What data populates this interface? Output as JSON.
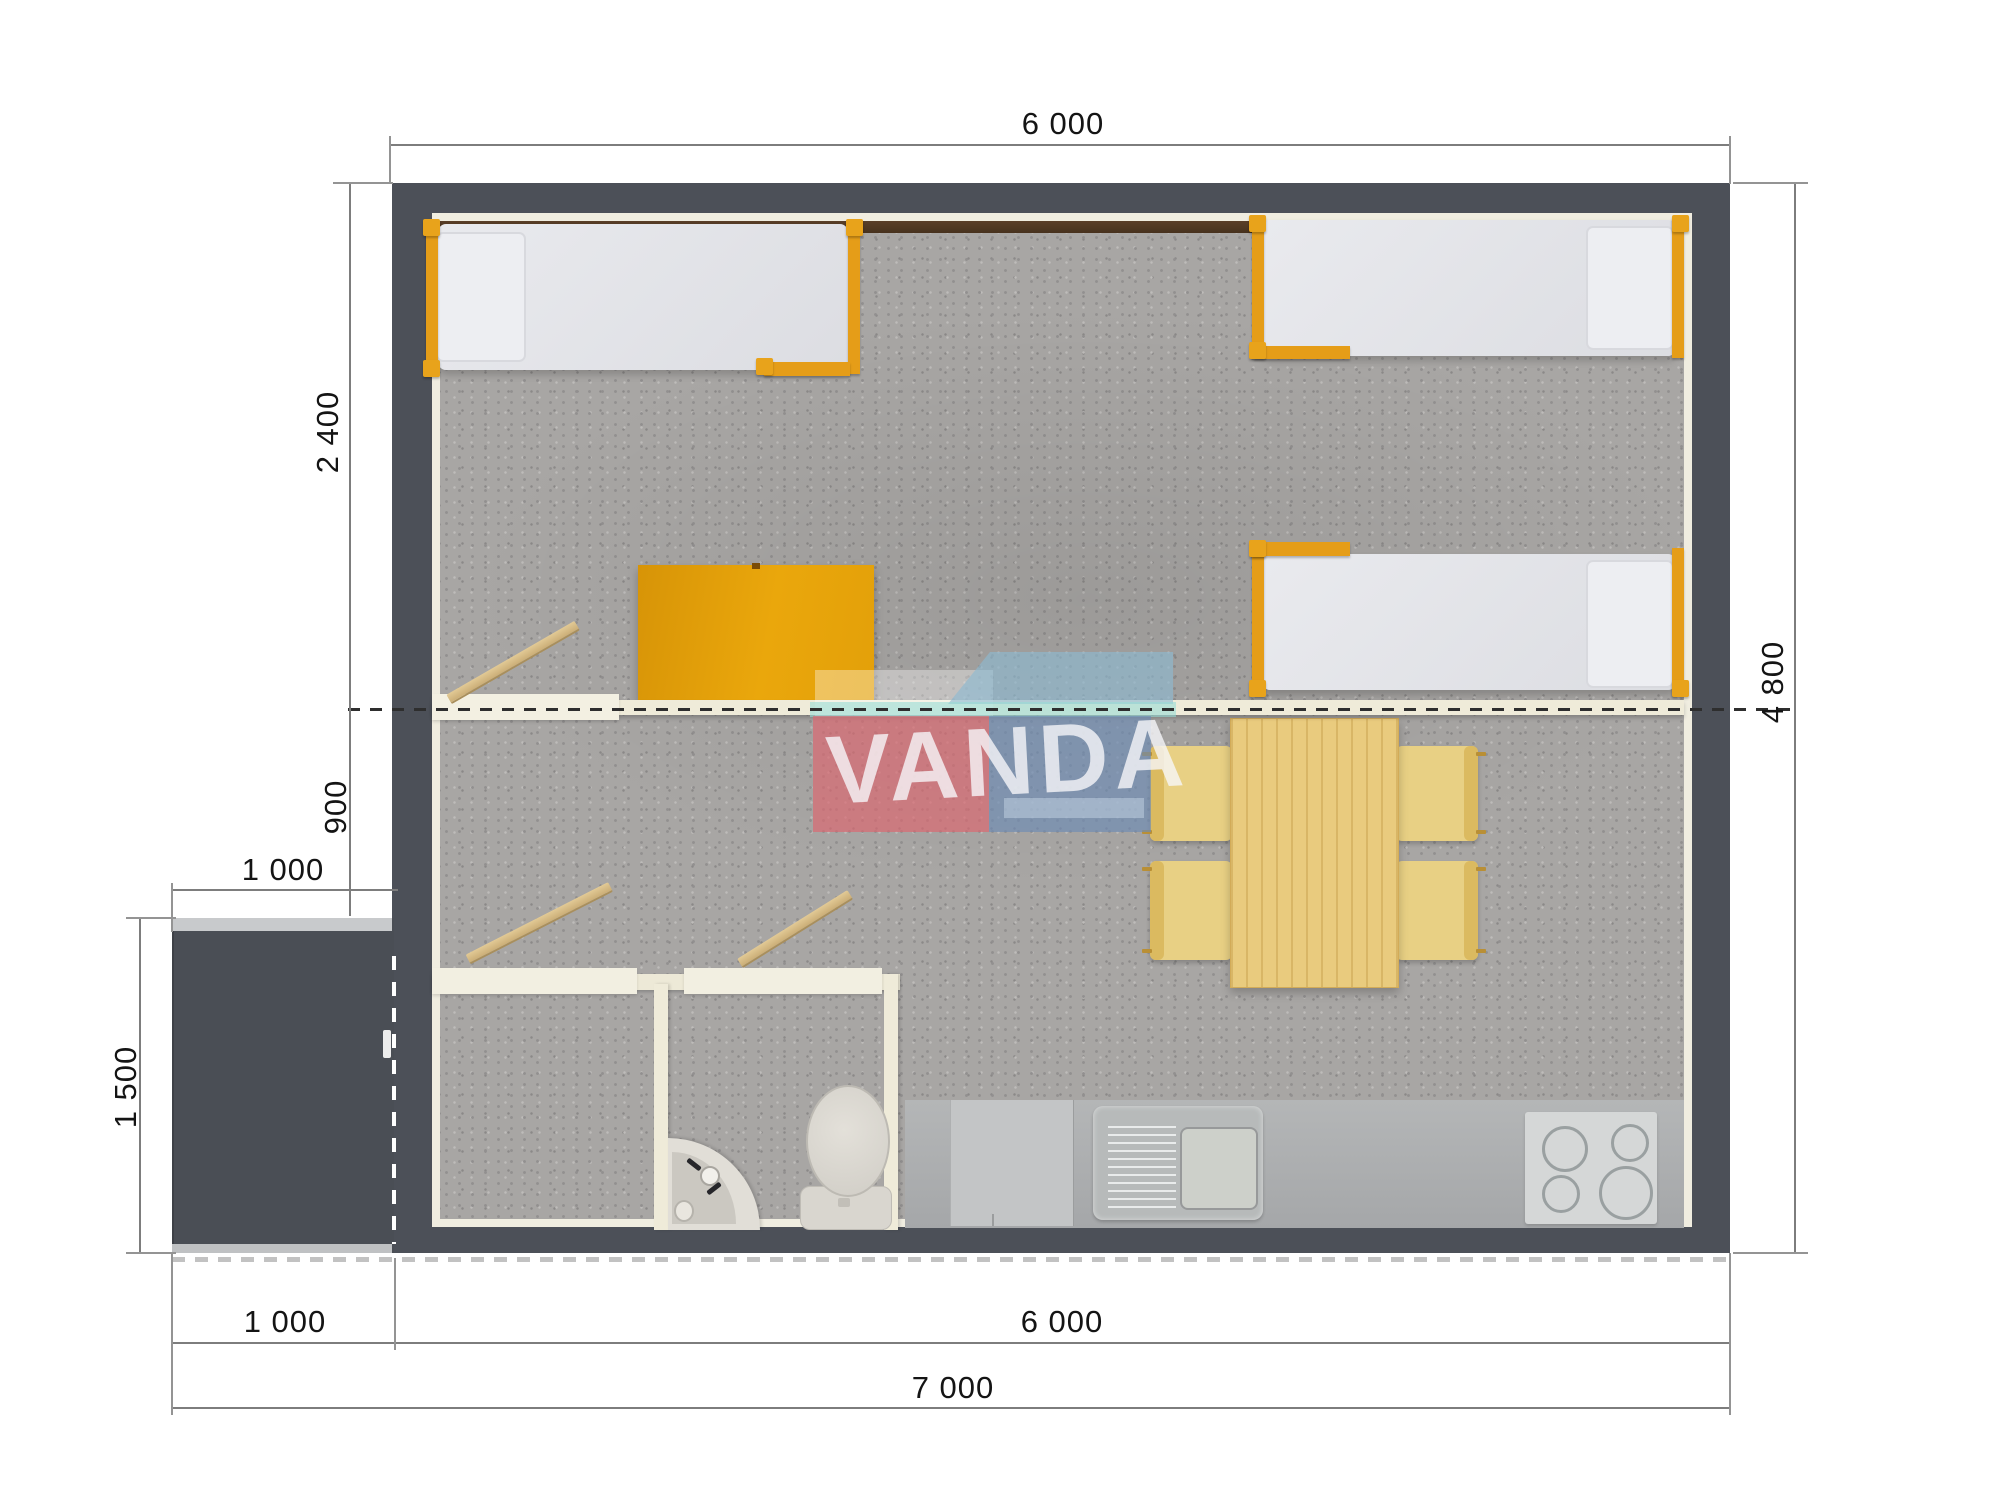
{
  "plan": {
    "watermark": {
      "text": "VANDA",
      "pink": "#dd656f",
      "blue": "#6e8cb4",
      "sky": "#8cb9d2",
      "teal": "#98dcd6",
      "text_color": "#f6f6f9"
    },
    "dimensions": {
      "top_width": "6 000",
      "left_bedroom_depth": "2 400",
      "left_hall_depth": "900",
      "left_porch_width": "1 000",
      "left_porch_depth": "1 500",
      "right_total_depth": "4 800",
      "bottom_porch_width": "1 000",
      "bottom_house_width": "6 000",
      "bottom_total_width": "7 000"
    },
    "colors": {
      "wall": "#4C5058",
      "floor_carpet": "#a8a6a4",
      "inner_lining": "#F0EDE0",
      "accent_orange": "#E59D18",
      "wardrobe_orange": "#e5a30b",
      "wood": "#E9CB7E",
      "chair": "#E8D084",
      "counter_gray": "#ACAEAF",
      "stove_gray": "#D5D7D7",
      "porch_dark": "#4A4E55",
      "dimension_line": "#7d7d7d",
      "dimension_text": "#141414"
    },
    "rooms": {
      "bedroom": "sleeping area with three single beds and wardrobe",
      "living": "dining table with four chairs and kitchen line",
      "bathroom": "two sanitary rooms with toilet and corner washbasin",
      "porch": "entrance terrace"
    }
  }
}
